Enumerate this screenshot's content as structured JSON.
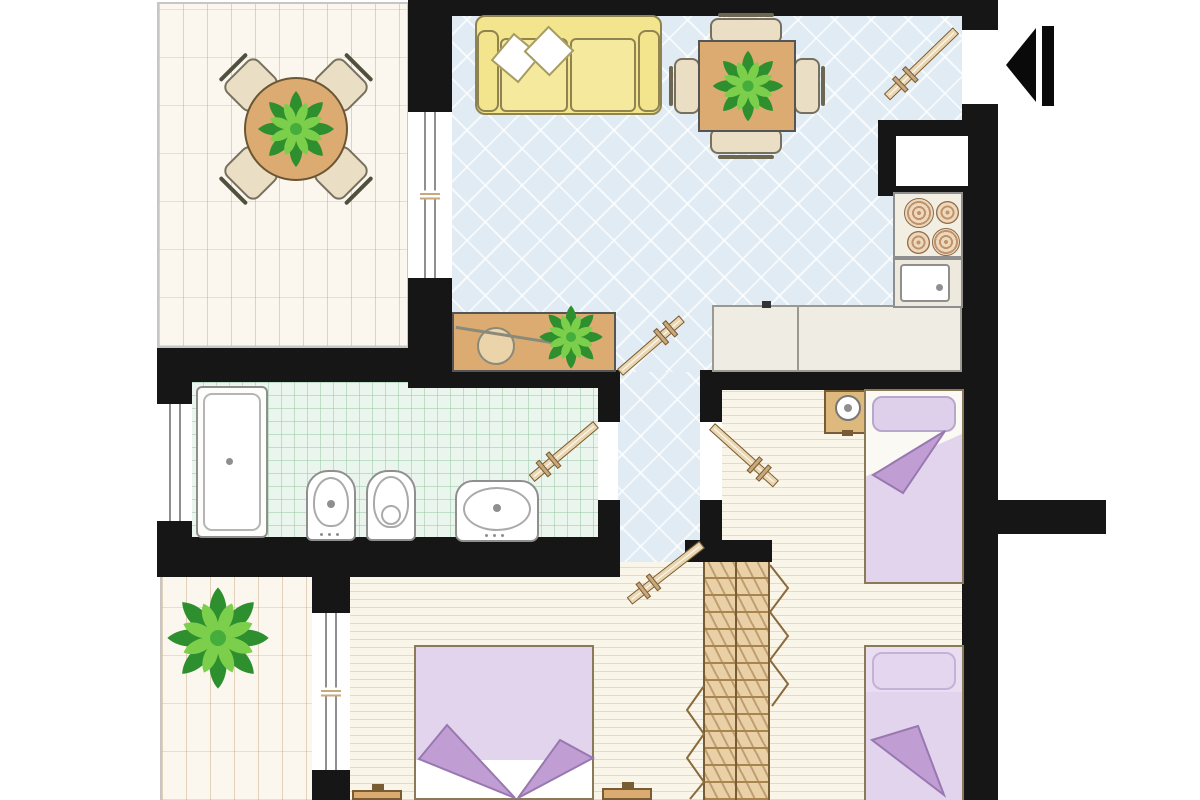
{
  "palette": {
    "wall": "#161616",
    "wall_trim": "#c6c6c6",
    "living_floor": "#e0ebf3",
    "terrace_floor": "#fbf7ee",
    "bath_floor": "#eaf5ee",
    "bedroom_floor": "#faf5e9",
    "wood": "#dcab72",
    "wood_dark": "#7a5c34",
    "chair": "#eadfc4",
    "sofa": "#f3e58e",
    "sofa_cushion": "#f5e99e",
    "sofa_line": "#8f8350",
    "pillow": "#ffffff",
    "bed_blanket": "#e2d4ec",
    "bed_fold": "#c09ed4",
    "bed_fold_line": "#9878b0",
    "bed_pillow": "#ded0ea",
    "bed_pillow_line": "#b9a6cc",
    "fixture_line": "#8f8f8f",
    "counter": "#efece3",
    "counter_line": "#9a9a92",
    "stair_wood": "#ead0a6",
    "stair_line": "#a9854e",
    "door_leaf": "#ead7b2",
    "door_line": "#7a5c34",
    "window_frame": "#8f8f8f",
    "window_tick": "#c9a87c",
    "arrow": "#0a0a0a",
    "plant_dark": "#2e8f2e",
    "plant_mid": "#44ad3c",
    "plant_light": "#7ccf4a"
  },
  "floor_plan": {
    "rooms": [
      {
        "id": "terrace-top",
        "floor": "cream-tile",
        "contents": [
          "round-table",
          "four-chairs",
          "plant"
        ]
      },
      {
        "id": "living-kitchen",
        "floor": "blue-diamond-tile",
        "contents": [
          "sofa",
          "two-pillows",
          "dining-table",
          "four-chairs",
          "plant",
          "sideboard",
          "plant",
          "kitchen-counter",
          "stove",
          "kitchen-sink",
          "pass-through-niche"
        ]
      },
      {
        "id": "bathroom",
        "floor": "mint-grid-tile",
        "contents": [
          "bathtub",
          "bidet",
          "toilet",
          "washbasin"
        ]
      },
      {
        "id": "hallway",
        "floor": "blue-diamond-tile",
        "contents": []
      },
      {
        "id": "bedroom-right",
        "floor": "wood-plank",
        "contents": [
          "single-bed-top",
          "single-bed-bottom",
          "nightstand-with-lamp"
        ]
      },
      {
        "id": "bedroom-bottom",
        "floor": "wood-plank",
        "contents": [
          "double-bed",
          "nightstand-left",
          "nightstand-right"
        ]
      },
      {
        "id": "terrace-bottom",
        "floor": "cream-tile",
        "contents": [
          "plant"
        ]
      },
      {
        "id": "staircase",
        "floor": "wood",
        "contents": [
          "stairs",
          "direction-zigzags"
        ]
      }
    ],
    "doors": [
      "entrance-door",
      "living-hallway-door",
      "bathroom-door",
      "bedroom-right-door",
      "bedroom-bottom-door"
    ],
    "windows": [
      "terrace-living-window",
      "bathroom-window",
      "terrace-bedroom-window",
      "kitchen-niche-window"
    ],
    "symbols": [
      "entrance-arrow"
    ]
  }
}
